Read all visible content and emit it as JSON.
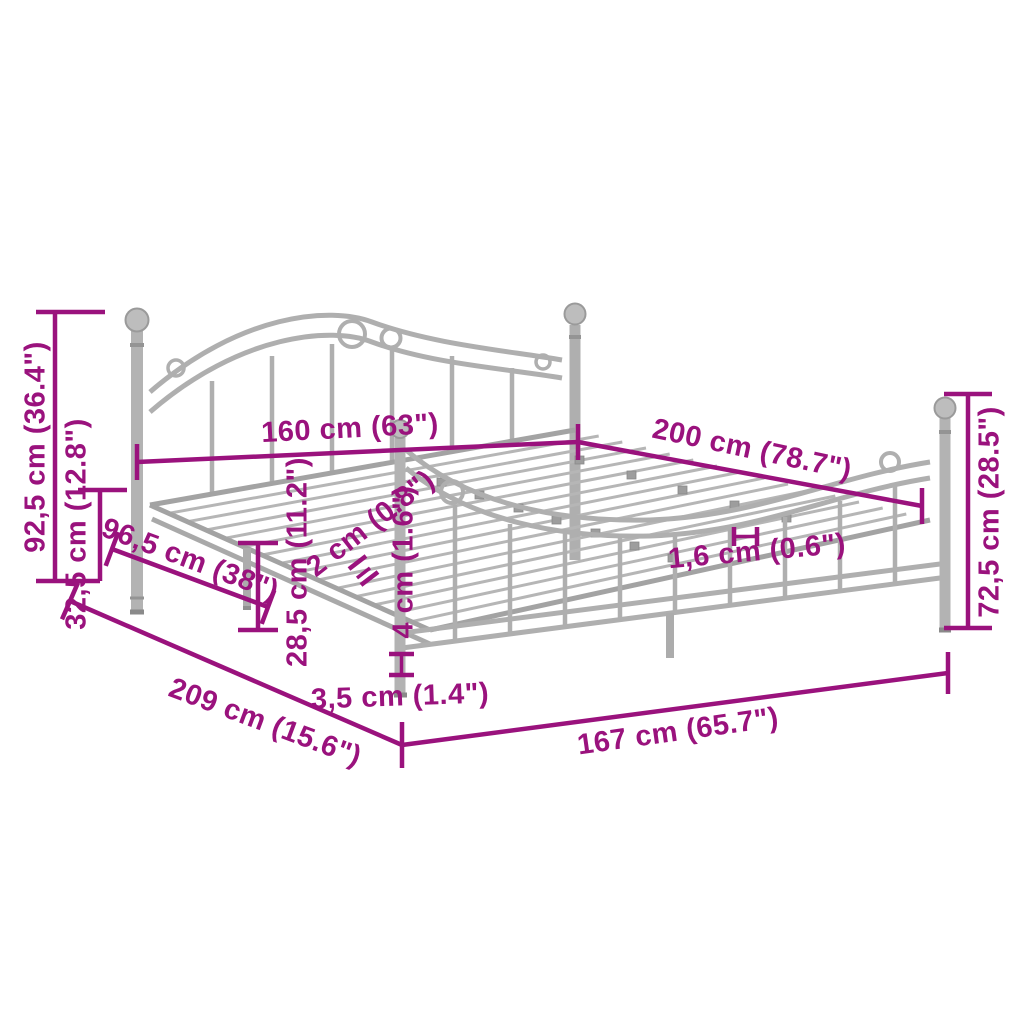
{
  "page": {
    "title": "Metal bed frame dimension diagram",
    "background_color": "#ffffff"
  },
  "colors": {
    "dimension_accent": "#9A127D",
    "frame_gray": "#ADADAD",
    "frame_gray_dark": "#8F8F8F",
    "frame_gray_light": "#C6C6C6"
  },
  "product": {
    "name": "gray-metal-bed-frame",
    "view": "perspective line drawing with dimension callouts"
  },
  "dimensions": [
    {
      "id": "total-height",
      "text": "92,5 cm (36.4\")"
    },
    {
      "id": "base-height",
      "text": "32,5 cm (12.8\")"
    },
    {
      "id": "headboard-side",
      "text": "96,5 cm (38\")"
    },
    {
      "id": "bed-width",
      "text": "160 cm (63\")"
    },
    {
      "id": "bed-length",
      "text": "200 cm (78.7\")"
    },
    {
      "id": "slat-thickness",
      "text": "2 cm (0.8\")"
    },
    {
      "id": "leg-depth",
      "text": "4 cm (1.6\")"
    },
    {
      "id": "slat-height",
      "text": "1,6 cm (0.6\")"
    },
    {
      "id": "under-bed-clearance",
      "text": "28,5 cm (11.2\")"
    },
    {
      "id": "frame-length",
      "text": "209 cm (15.6\")"
    },
    {
      "id": "leg-width",
      "text": "3,5 cm (1.4\")"
    },
    {
      "id": "frame-inner-length",
      "text": "167 cm (65.7\")"
    },
    {
      "id": "footboard-height",
      "text": "72,5 cm (28.5\")"
    }
  ]
}
